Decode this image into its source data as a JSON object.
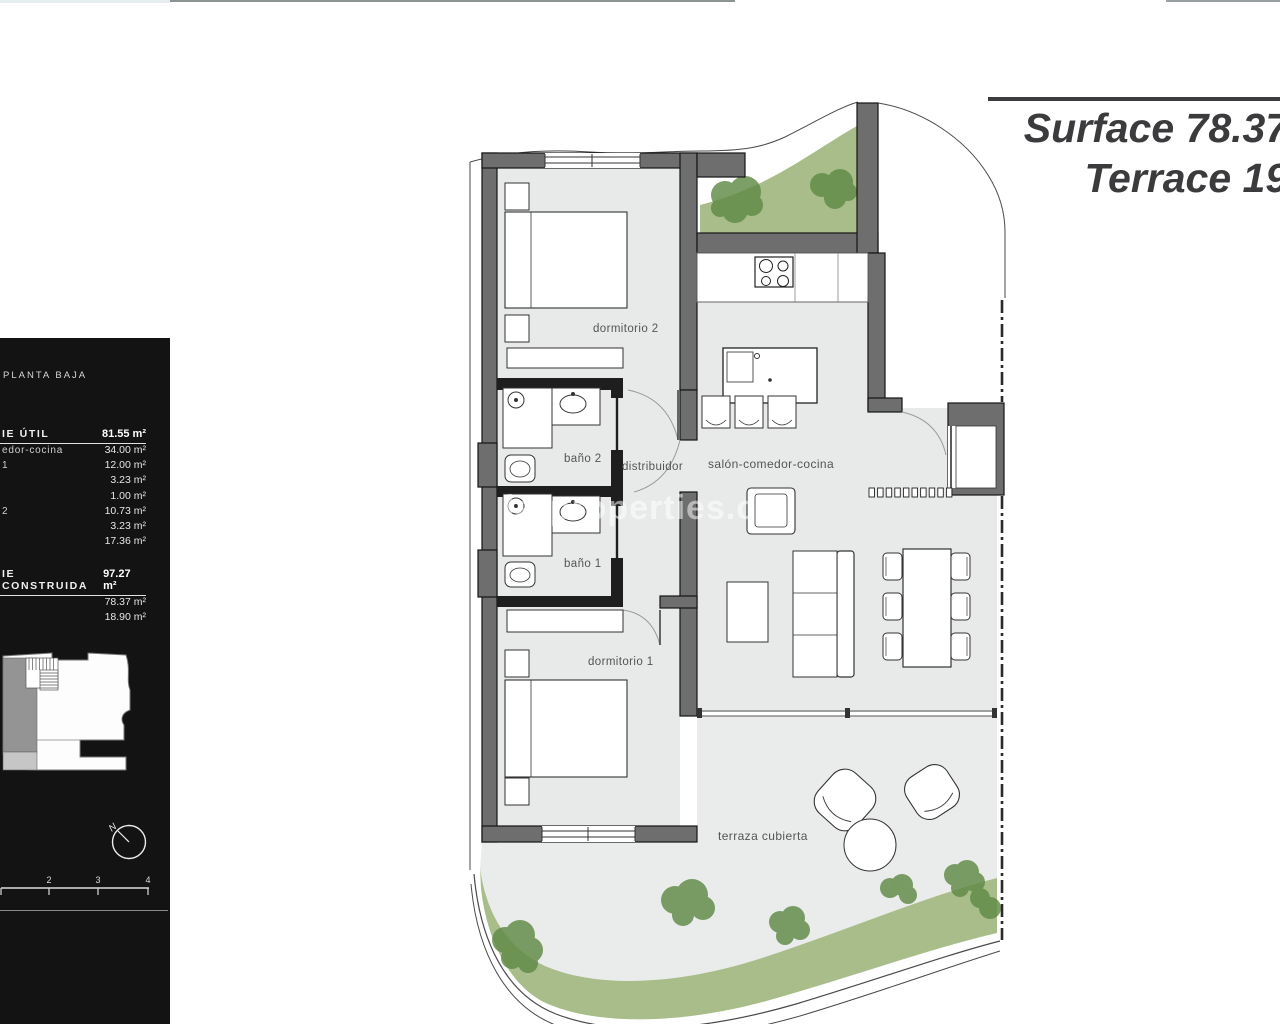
{
  "header": {
    "surface_line": "Surface 78.37 m",
    "terrace_line": "Terrace 19 m"
  },
  "sidebar": {
    "floor_label": "PLANTA BAJA",
    "util": {
      "title": "IE ÚTIL",
      "total": "81.55 m²",
      "rows": [
        {
          "label": "edor-cocina",
          "value": "34.00 m²"
        },
        {
          "label": "1",
          "value": "12.00 m²"
        },
        {
          "label": "",
          "value": "3.23 m²"
        },
        {
          "label": "",
          "value": "1.00 m²"
        },
        {
          "label": "2",
          "value": "10.73 m²"
        },
        {
          "label": "",
          "value": "3.23 m²"
        },
        {
          "label": "",
          "value": "17.36 m²"
        }
      ]
    },
    "construida": {
      "title": "IE CONSTRUIDA",
      "total": "97.27 m²",
      "rows": [
        {
          "label": "",
          "value": "78.37 m²"
        },
        {
          "label": "",
          "value": "18.90 m²"
        }
      ]
    },
    "compass_label": "N",
    "scale_ticks": [
      "2",
      "3",
      "4"
    ]
  },
  "plan": {
    "labels": {
      "dormitorio2": "dormitorio 2",
      "bano2": "baño 2",
      "distribuidor": "distribuidor",
      "salon": "salón-comedor-cocina",
      "bano1": "baño 1",
      "dormitorio1": "dormitorio 1",
      "terraza": "terraza cubierta"
    },
    "watermark": "larproperties.co"
  },
  "colors": {
    "wall": "#6e6e6e",
    "wall_dark": "#1e1e1e",
    "floor": "#e8eaea",
    "terrace_floor": "#eaecec",
    "garden": "#a8bd8a",
    "garden_bush": "#5f8a45",
    "sidebar_bg": "#131313",
    "header_text": "#3b3b3d"
  }
}
